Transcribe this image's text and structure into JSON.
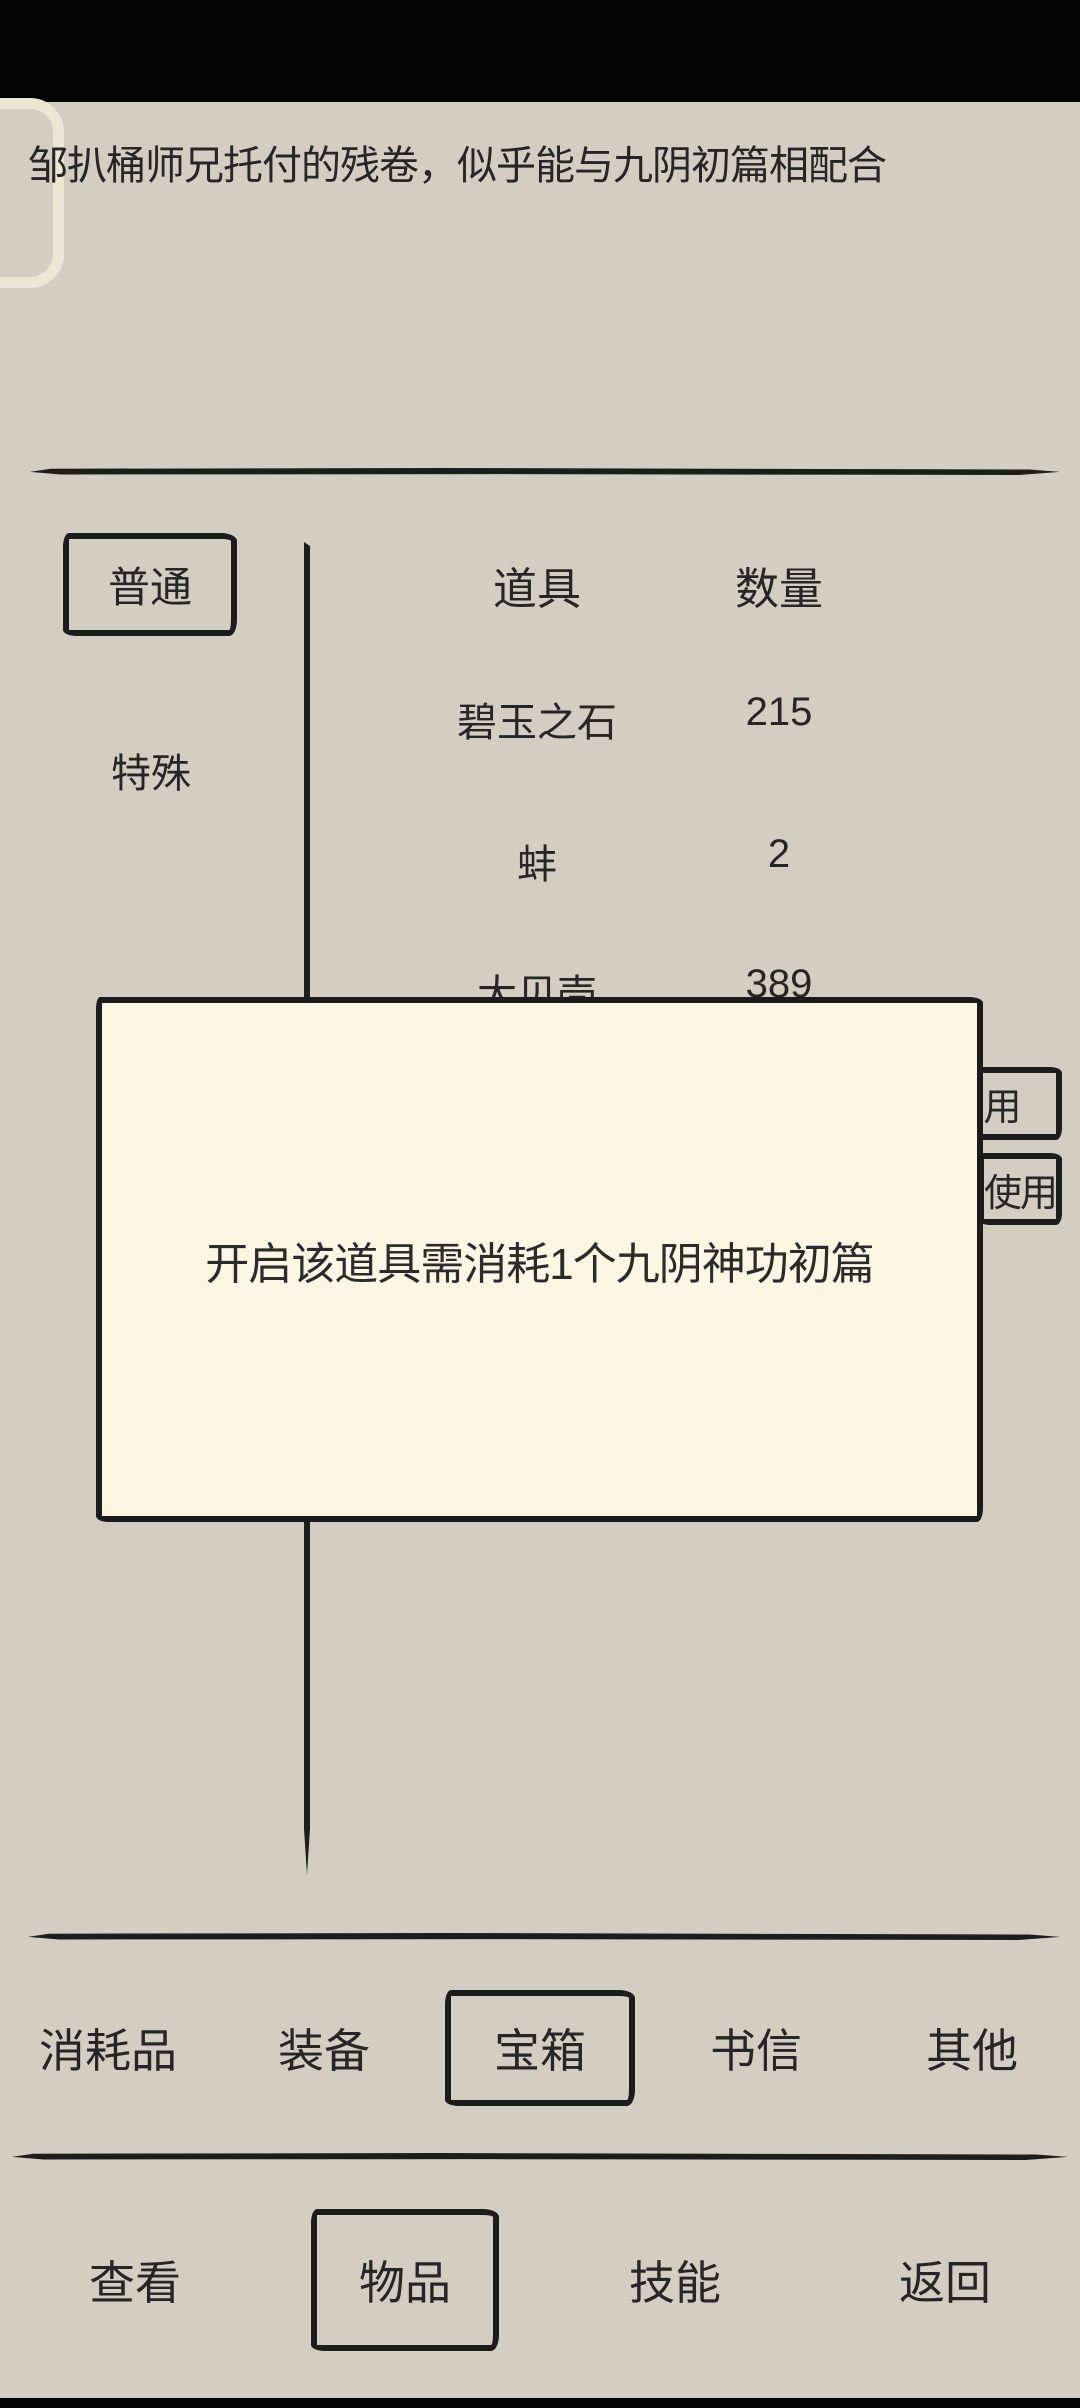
{
  "colors": {
    "background": "#d3cec1",
    "modal_background": "#fcf6e3",
    "ink": "#1d1d1d",
    "text": "#262626",
    "status_bar": "#050505"
  },
  "caption": "邹扒桶师兄托付的残卷，似乎能与九阴初篇相配合",
  "categories": {
    "items": [
      {
        "label": "普通",
        "selected": true
      },
      {
        "label": "特殊",
        "selected": false
      }
    ]
  },
  "table": {
    "header": {
      "item_col": "道具",
      "qty_col": "数量"
    },
    "rows": [
      {
        "item": "碧玉之石",
        "qty": "215"
      },
      {
        "item": "蚌",
        "qty": "2"
      },
      {
        "item": "大贝壳",
        "qty": "389"
      }
    ]
  },
  "action_buttons": [
    {
      "label": "使用"
    },
    {
      "label": "使用"
    }
  ],
  "modal": {
    "message": "开启该道具需消耗1个九阴神功初篇"
  },
  "tabs": {
    "items": [
      {
        "label": "消耗品",
        "selected": false
      },
      {
        "label": "装备",
        "selected": false
      },
      {
        "label": "宝箱",
        "selected": true
      },
      {
        "label": "书信",
        "selected": false
      },
      {
        "label": "其他",
        "selected": false
      }
    ]
  },
  "nav": {
    "items": [
      {
        "label": "查看",
        "selected": false
      },
      {
        "label": "物品",
        "selected": true
      },
      {
        "label": "技能",
        "selected": false
      },
      {
        "label": "返回",
        "selected": false
      }
    ]
  }
}
